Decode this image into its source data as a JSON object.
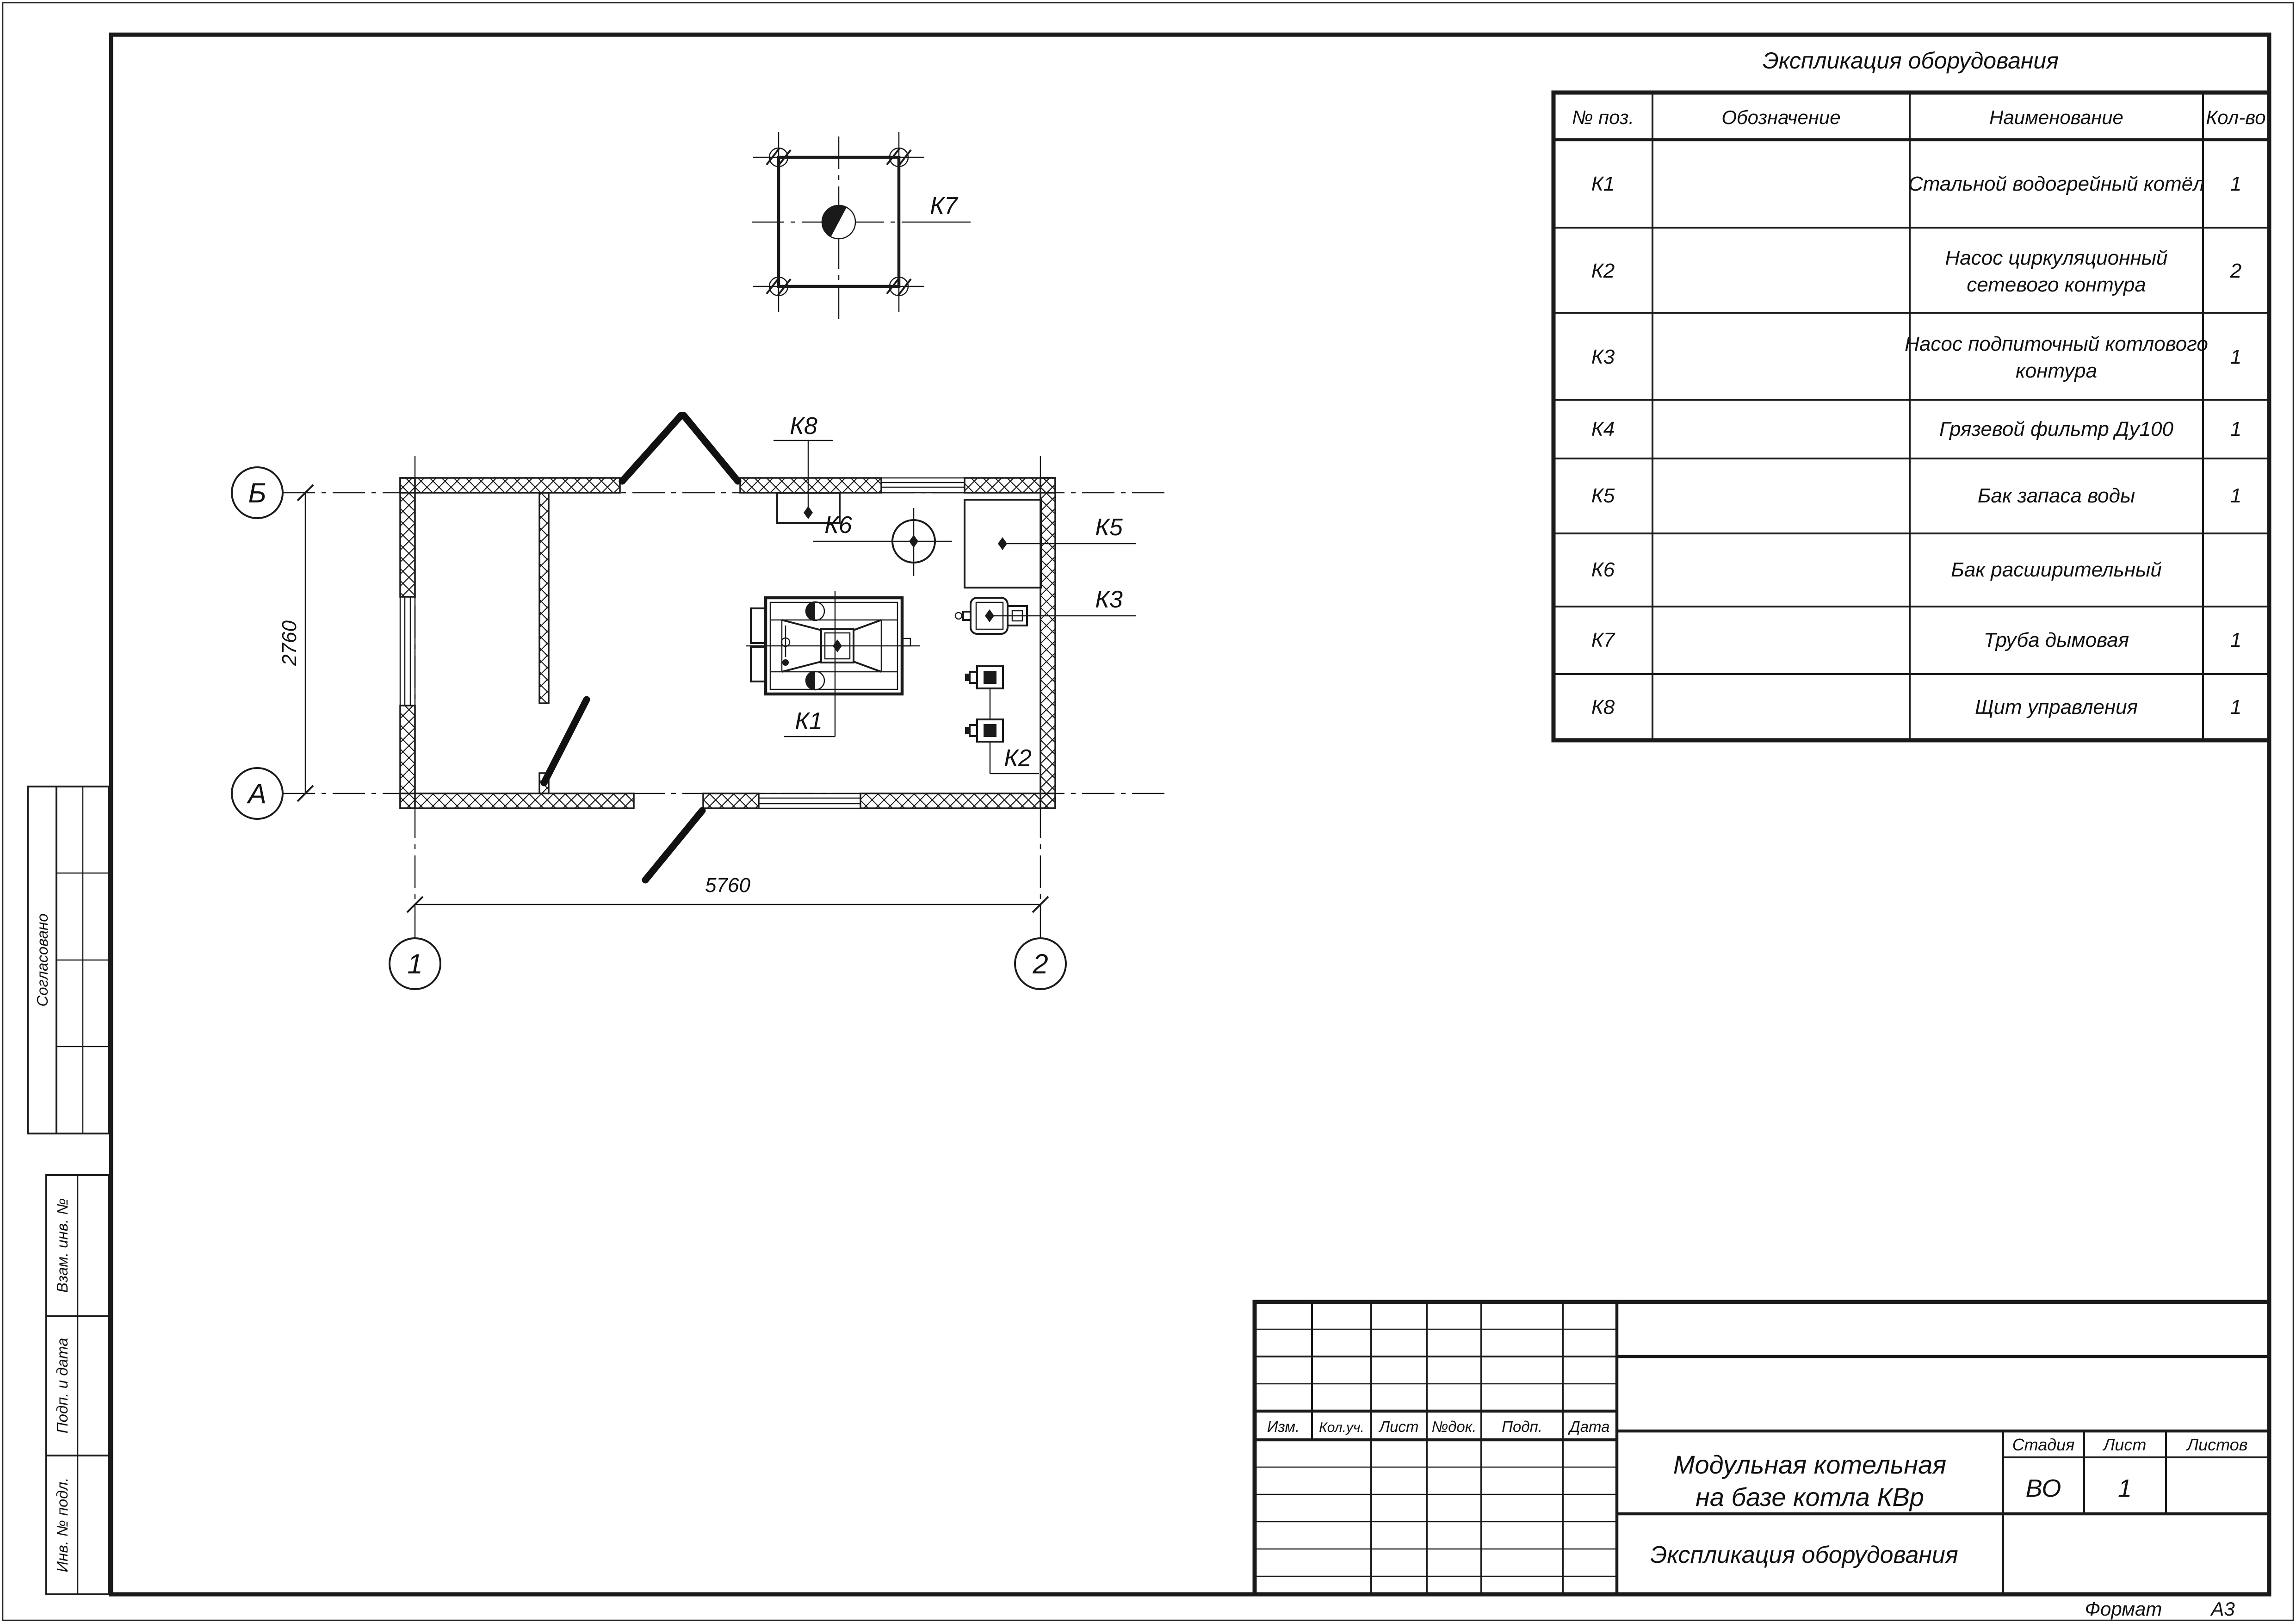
{
  "colors": {
    "ink": "#1a1a1a",
    "paper": "#ffffff"
  },
  "spec_table": {
    "title": "Экспликация оборудования",
    "headers": {
      "pos": "№ поз.",
      "designation": "Обозначение",
      "name": "Наименование",
      "qty": "Кол-во"
    },
    "rows": [
      {
        "pos": "К1",
        "name": "Стальной водогрейный котёл",
        "name2": "",
        "qty": "1"
      },
      {
        "pos": "К2",
        "name": "Насос циркуляционный",
        "name2": "сетевого контура",
        "qty": "2"
      },
      {
        "pos": "К3",
        "name": "Насос подпиточный котлового",
        "name2": "контура",
        "qty": "1"
      },
      {
        "pos": "К4",
        "name": "Грязевой фильтр Ду100",
        "name2": "",
        "qty": "1"
      },
      {
        "pos": "К5",
        "name": "Бак запаса воды",
        "name2": "",
        "qty": "1"
      },
      {
        "pos": "К6",
        "name": "Бак расширительный",
        "name2": "",
        "qty": ""
      },
      {
        "pos": "К7",
        "name": "Труба дымовая",
        "name2": "",
        "qty": "1"
      },
      {
        "pos": "К8",
        "name": "Щит управления",
        "name2": "",
        "qty": "1"
      }
    ]
  },
  "plan": {
    "axis_labels": {
      "row_top": "Б",
      "row_bottom": "А",
      "col_left": "1",
      "col_right": "2"
    },
    "dimensions": {
      "width": "5760",
      "height": "2760"
    },
    "callouts": {
      "k1": "К1",
      "k2": "К2",
      "k3": "К3",
      "k5": "К5",
      "k6": "К6",
      "k7": "К7",
      "k8": "К8"
    }
  },
  "title_block": {
    "columns": [
      "Изм.",
      "Кол.уч.",
      "Лист",
      "№док.",
      "Подп.",
      "Дата"
    ],
    "project_title_line1": "Модульная котельная",
    "project_title_line2": "на базе котла КВр",
    "doc_title": "Экспликация оборудования",
    "stage_label": "Стадия",
    "sheet_label": "Лист",
    "sheets_label": "Листов",
    "stage_value": "ВО",
    "sheet_value": "1",
    "sheets_value": "",
    "format_label": "Формат",
    "format_value": "А3"
  },
  "sidebar": {
    "approved": "Согласовано",
    "repl_inv": "Взам. инв. №",
    "sign_date": "Подп. и дата",
    "inv_orig": "Инв. № подл."
  }
}
